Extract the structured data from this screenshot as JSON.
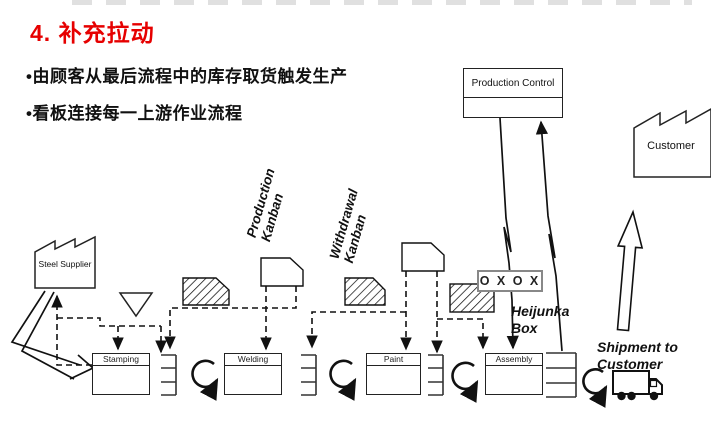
{
  "slide": {
    "title": "4. 补充拉动",
    "bullets": [
      "•由顾客从最后流程中的库存取货触发生产",
      "•看板连接每一上游作业流程"
    ]
  },
  "diagram": {
    "production_control": "Production Control",
    "customer_label": "Customer",
    "steel_supplier": "Steel Supplier",
    "processes": [
      "Stamping",
      "Welding",
      "Paint",
      "Assembly"
    ],
    "production_kanban": [
      "Production",
      "Kanban"
    ],
    "withdrawal_kanban": [
      "Withdrawal",
      "Kanban"
    ],
    "heijunka_label": [
      "Heijunka",
      "Box"
    ],
    "heijunka_pattern": "O X O X",
    "shipment_label": [
      "Shipment to",
      "Customer"
    ]
  },
  "colors": {
    "title_red": "#e60000",
    "line": "#111111",
    "heijunka_border": "#888888"
  }
}
